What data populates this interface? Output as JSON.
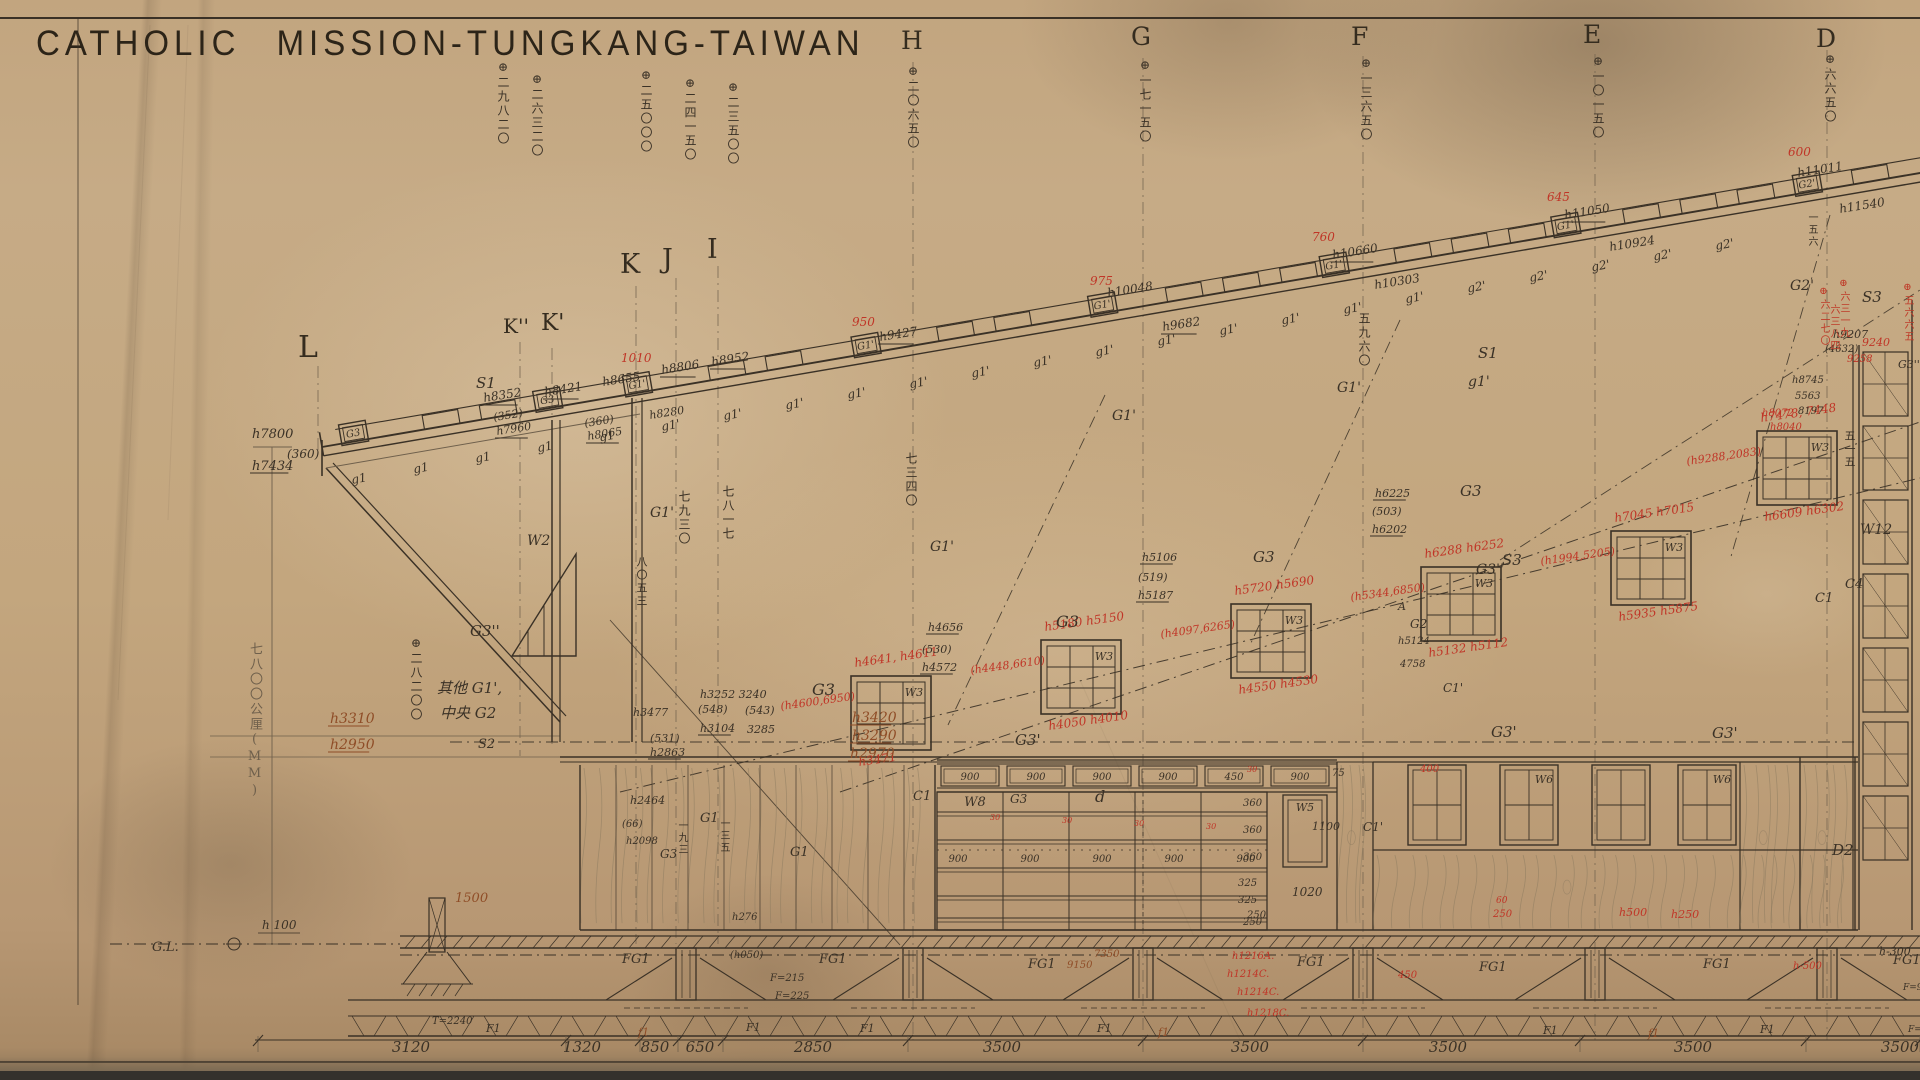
{
  "title": "CATHOLIC MISSION-TUNGKANG-TAIWAN",
  "colors": {
    "paper": "#c3a67e",
    "ink": "#3a3126",
    "pencil": "#77685280",
    "red": "#c03527",
    "brown": "#8f4d27"
  },
  "letters": [
    {
      "t": "L",
      "x": 298,
      "y": 330,
      "s": 30
    },
    {
      "t": "K''",
      "x": 503,
      "y": 314,
      "s": 20
    },
    {
      "t": "K'",
      "x": 541,
      "y": 310,
      "s": 23
    },
    {
      "t": "K",
      "x": 620,
      "y": 249,
      "s": 27
    },
    {
      "t": "J",
      "x": 662,
      "y": 244,
      "s": 27
    },
    {
      "t": "I",
      "x": 707,
      "y": 234,
      "s": 27
    },
    {
      "t": "H",
      "x": 901,
      "y": 26,
      "s": 25
    },
    {
      "t": "G",
      "x": 1131,
      "y": 22,
      "s": 25
    },
    {
      "t": "F",
      "x": 1351,
      "y": 22,
      "s": 25
    },
    {
      "t": "E",
      "x": 1583,
      "y": 20,
      "s": 25
    },
    {
      "t": "D",
      "x": 1816,
      "y": 24,
      "s": 25
    }
  ],
  "grid_lines": [
    {
      "x": 318,
      "y1": 366,
      "y2": 452
    },
    {
      "x": 520,
      "y1": 342,
      "y2": 756
    },
    {
      "x": 552,
      "y1": 348,
      "y2": 745
    },
    {
      "x": 636,
      "y1": 286,
      "y2": 944
    },
    {
      "x": 676,
      "y1": 278,
      "y2": 944
    },
    {
      "x": 718,
      "y1": 266,
      "y2": 944
    },
    {
      "x": 913,
      "y1": 62,
      "y2": 1040
    },
    {
      "x": 1143,
      "y1": 58,
      "y2": 1040
    },
    {
      "x": 1363,
      "y1": 56,
      "y2": 1040
    },
    {
      "x": 1595,
      "y1": 54,
      "y2": 1040
    },
    {
      "x": 1827,
      "y1": 50,
      "y2": 1040
    }
  ],
  "top_columns": [
    {
      "x": 497,
      "y": 60,
      "t": "⊕二九八二〇"
    },
    {
      "x": 531,
      "y": 72,
      "t": "⊕二六三二〇"
    },
    {
      "x": 640,
      "y": 68,
      "t": "⊕二五〇〇〇"
    },
    {
      "x": 684,
      "y": 76,
      "t": "⊕二四一五〇"
    },
    {
      "x": 727,
      "y": 80,
      "t": "⊕二三五〇〇"
    },
    {
      "x": 907,
      "y": 64,
      "t": "⊕二〇六五〇"
    },
    {
      "x": 1139,
      "y": 58,
      "t": "⊕一七一五〇"
    },
    {
      "x": 1360,
      "y": 56,
      "t": "⊕一三六五〇"
    },
    {
      "x": 1592,
      "y": 54,
      "t": "⊕一〇一五〇"
    },
    {
      "x": 1824,
      "y": 52,
      "t": "⊕六六五〇"
    }
  ],
  "vertical_texts": [
    {
      "x": 678,
      "y": 490,
      "t": "七九三〇",
      "c": "vk",
      "s": 12
    },
    {
      "x": 722,
      "y": 485,
      "t": "七八一七",
      "c": "vk",
      "s": 12
    },
    {
      "x": 905,
      "y": 452,
      "t": "七三四〇",
      "c": "vk",
      "s": 12
    },
    {
      "x": 1358,
      "y": 312,
      "t": "五九六〇",
      "c": "vk",
      "s": 12
    },
    {
      "x": 1844,
      "y": 430,
      "t": "五一五",
      "c": "vk",
      "s": 11
    },
    {
      "x": 1806,
      "y": 212,
      "t": "一五六",
      "c": "vk",
      "s": 10
    },
    {
      "x": 636,
      "y": 556,
      "t": "八〇五三",
      "c": "vk",
      "s": 11
    },
    {
      "x": 410,
      "y": 636,
      "t": "⊕二八二〇〇",
      "c": "vk",
      "s": 12
    },
    {
      "x": 248,
      "y": 642,
      "t": "七八〇〇公厘(MM)",
      "c": "vp",
      "s": 13
    },
    {
      "x": 676,
      "y": 820,
      "t": "一九三",
      "c": "vk",
      "s": 10
    },
    {
      "x": 718,
      "y": 818,
      "t": "一三五",
      "c": "vk",
      "s": 10
    },
    {
      "x": 1818,
      "y": 286,
      "t": "⊕六二七〇",
      "c": "vr",
      "s": 10
    },
    {
      "x": 1838,
      "y": 278,
      "t": "⊕六三一九",
      "c": "vr",
      "s": 10
    },
    {
      "x": 1828,
      "y": 304,
      "t": "六三八四",
      "c": "vr",
      "s": 10
    },
    {
      "x": 1902,
      "y": 282,
      "t": "⊕五六六五",
      "c": "vr",
      "s": 10
    }
  ],
  "roof": {
    "x1": 322,
    "y1": 447,
    "x2": 1920,
    "y2": 173,
    "boxes": [
      {
        "lx": 20,
        "t": "G3"
      },
      {
        "lx": 217,
        "t": "G3"
      },
      {
        "lx": 308,
        "t": "G1'"
      },
      {
        "lx": 540,
        "t": "G1'"
      },
      {
        "lx": 780,
        "t": "G1'"
      },
      {
        "lx": 1015,
        "t": "G1'"
      },
      {
        "lx": 1250,
        "t": "G1'"
      },
      {
        "lx": 1495,
        "t": "G2'"
      }
    ]
  },
  "windows_w3": [
    {
      "x": 851,
      "y": 676,
      "label": "W3",
      "top": "h4641, h4611",
      "left": "(h4600,6950)",
      "bottom": "h3471"
    },
    {
      "x": 1041,
      "y": 640,
      "label": "W3",
      "top": "h5180 h5150",
      "left": "(h4448,6610)",
      "bottom": "h4050  h4010"
    },
    {
      "x": 1231,
      "y": 604,
      "label": "W3",
      "top": "h5720 h5690",
      "left": "(h4097,6265)",
      "bottom": "h4550  h4530"
    },
    {
      "x": 1421,
      "y": 567,
      "label": "W3",
      "top": "h6288 h6252",
      "left": "(h5344,6850)",
      "bottom": "h5132  h5112"
    },
    {
      "x": 1611,
      "y": 531,
      "label": "W3",
      "top": "h7045 h7015",
      "left": "(h1994,5205)",
      "bottom": "h5935  h5875"
    },
    {
      "x": 1757,
      "y": 431,
      "label": "W3",
      "top": "h7478, 7448",
      "left": "(h9288,2083)",
      "bottom": "h6609  h6302"
    }
  ],
  "clerestory": {
    "x": 937,
    "x2": 1337,
    "labels": [
      "900",
      "900",
      "900",
      "900",
      "450",
      "900"
    ],
    "w8_label": "W8",
    "end_label": "75"
  },
  "right_windows": [
    {
      "x": 1408,
      "label": ""
    },
    {
      "x": 1500,
      "label": "W6"
    },
    {
      "x": 1592,
      "label": ""
    },
    {
      "x": 1678,
      "label": "W6"
    }
  ],
  "w5": {
    "x": 1283,
    "y": 795,
    "label": "W5",
    "dim_right": "1100",
    "dim_below": "1020"
  },
  "w12": {
    "x": 1859,
    "label": "W12"
  },
  "panel_rows": [
    "360",
    "360",
    "360",
    "325",
    "325",
    "250"
  ],
  "panel_900s": [
    958,
    1030,
    1102,
    1174,
    1246
  ],
  "footings": {
    "centers": [
      686,
      913,
      1143,
      1363,
      1595,
      1827
    ],
    "porch": 437,
    "fg_labels": [
      [
        622,
        963
      ],
      [
        819,
        963
      ],
      [
        1028,
        968
      ],
      [
        1297,
        966
      ],
      [
        1479,
        971
      ],
      [
        1703,
        968
      ],
      [
        1893,
        964
      ]
    ],
    "fg_text": "FG1",
    "f1_labels": [
      [
        486,
        1032
      ],
      [
        746,
        1031
      ],
      [
        860,
        1032
      ],
      [
        1097,
        1032
      ],
      [
        1543,
        1034
      ],
      [
        1760,
        1033
      ]
    ],
    "f1_text": "F1",
    "f1_red": [
      [
        638,
        1036
      ],
      [
        1158,
        1036
      ],
      [
        1648,
        1037
      ]
    ],
    "f1_red_text": "f1"
  },
  "bottom_dims": {
    "y": 1048,
    "ticks": [
      258,
      566,
      640,
      678,
      723,
      908,
      1143,
      1363,
      1580,
      1806,
      1920
    ],
    "labels": [
      {
        "t": "3120",
        "x": 411
      },
      {
        "t": "1320",
        "x": 582
      },
      {
        "t": "850",
        "x": 655
      },
      {
        "t": "650",
        "x": 700
      },
      {
        "t": "2850",
        "x": 813
      },
      {
        "t": "3500",
        "x": 1002
      },
      {
        "t": "3500",
        "x": 1250
      },
      {
        "t": "3500",
        "x": 1448
      },
      {
        "t": "3500",
        "x": 1693
      },
      {
        "t": "3500",
        "x": 1900
      }
    ]
  },
  "gl": {
    "label": "G.L.",
    "h_label": "h 100"
  },
  "annotations": [
    [
      484,
      402,
      "h8352",
      "k",
      12,
      -9,
      1
    ],
    [
      545,
      396,
      "h8421",
      "k",
      12,
      -9,
      1
    ],
    [
      603,
      386,
      "h8655",
      "k",
      12,
      -9,
      0
    ],
    [
      662,
      374,
      "h8806",
      "k",
      12,
      -9,
      1
    ],
    [
      712,
      366,
      "h8952",
      "k",
      12,
      -9,
      1
    ],
    [
      880,
      341,
      "h9427",
      "k",
      12,
      -9,
      1
    ],
    [
      1108,
      297,
      "h10048",
      "k",
      12,
      -9,
      0
    ],
    [
      1163,
      331,
      "h9682",
      "k",
      12,
      -9,
      1
    ],
    [
      1375,
      289,
      "h10303",
      "k",
      12,
      -9,
      0
    ],
    [
      1333,
      259,
      "h10660",
      "k",
      12,
      -9,
      1
    ],
    [
      1565,
      219,
      "h11050",
      "k",
      12,
      -9,
      1
    ],
    [
      1610,
      251,
      "h10924",
      "k",
      12,
      -9,
      0
    ],
    [
      1798,
      177,
      "h11011",
      "k",
      12,
      -9,
      0
    ],
    [
      1840,
      213,
      "h11540",
      "k",
      12,
      -9,
      0
    ],
    [
      852,
      326,
      "950",
      "r",
      12,
      0,
      0
    ],
    [
      1090,
      285,
      "975",
      "r",
      12,
      0,
      0
    ],
    [
      1312,
      241,
      "760",
      "r",
      12,
      0,
      0
    ],
    [
      1547,
      201,
      "645",
      "r",
      12,
      0,
      0
    ],
    [
      1788,
      156,
      "600",
      "r",
      12,
      0,
      0
    ],
    [
      621,
      362,
      "1010",
      "r",
      12,
      0,
      0
    ],
    [
      252,
      438,
      "h7800",
      "k",
      13,
      0,
      0
    ],
    [
      287,
      458,
      "(360)",
      "k",
      12,
      0,
      0
    ],
    [
      252,
      470,
      "h7434",
      "k",
      13,
      0,
      1
    ],
    [
      494,
      421,
      "(352)",
      "k",
      11,
      -9,
      0
    ],
    [
      497,
      435,
      "h7960",
      "k",
      11,
      -9,
      1
    ],
    [
      585,
      427,
      "(360)",
      "k",
      11,
      -9,
      0
    ],
    [
      588,
      440,
      "h8065",
      "k",
      11,
      -9,
      1
    ],
    [
      650,
      419,
      "h8280",
      "k",
      11,
      -9,
      0
    ],
    [
      476,
      388,
      "S1",
      "k",
      15,
      0,
      0
    ],
    [
      1478,
      358,
      "S1",
      "k",
      15,
      0,
      0
    ],
    [
      1468,
      386,
      "g1'",
      "k",
      14,
      0,
      0
    ],
    [
      1502,
      565,
      "S3",
      "k",
      15,
      0,
      0
    ],
    [
      1862,
      302,
      "S3",
      "k",
      15,
      0,
      0
    ],
    [
      470,
      636,
      "G3''",
      "k",
      15,
      0,
      0
    ],
    [
      1476,
      574,
      "G3''",
      "k",
      14,
      0,
      0
    ],
    [
      812,
      695,
      "G3",
      "k",
      16,
      0,
      0
    ],
    [
      1056,
      627,
      "G3",
      "k",
      16,
      0,
      0
    ],
    [
      1253,
      562,
      "G3",
      "k",
      15,
      0,
      0
    ],
    [
      1460,
      496,
      "G3",
      "k",
      15,
      0,
      0
    ],
    [
      1015,
      745,
      "G3'",
      "k",
      15,
      0,
      0
    ],
    [
      1491,
      737,
      "G3'",
      "k",
      15,
      0,
      0
    ],
    [
      1712,
      738,
      "G3'",
      "k",
      15,
      0,
      0
    ],
    [
      650,
      517,
      "G1'",
      "k",
      14,
      0,
      0
    ],
    [
      930,
      551,
      "G1'",
      "k",
      14,
      0,
      0
    ],
    [
      1112,
      420,
      "G1'",
      "k",
      14,
      0,
      0
    ],
    [
      1337,
      392,
      "G1'",
      "k",
      14,
      0,
      0
    ],
    [
      1790,
      290,
      "G2'",
      "k",
      14,
      0,
      0
    ],
    [
      1410,
      628,
      "G2",
      "k",
      12,
      0,
      0
    ],
    [
      1398,
      610,
      "A",
      "k",
      11,
      0,
      0
    ],
    [
      527,
      545,
      "W2",
      "k",
      14,
      0,
      0
    ],
    [
      437,
      693,
      "其他 G1',",
      "k",
      15,
      0,
      0
    ],
    [
      440,
      718,
      "中央 G2",
      "k",
      15,
      0,
      0
    ],
    [
      478,
      748,
      "S2",
      "k",
      13,
      0,
      0
    ],
    [
      633,
      716,
      "h3477",
      "k",
      11,
      0,
      0
    ],
    [
      700,
      698,
      "h3252 3240",
      "k",
      11,
      0,
      0
    ],
    [
      698,
      713,
      "(548)",
      "k",
      11,
      0,
      0
    ],
    [
      745,
      714,
      "(543)",
      "k",
      11,
      0,
      0
    ],
    [
      700,
      732,
      "h3104",
      "k",
      11,
      0,
      1
    ],
    [
      747,
      733,
      "3285",
      "k",
      11,
      0,
      0
    ],
    [
      650,
      742,
      "(531)",
      "k",
      11,
      0,
      0
    ],
    [
      650,
      756,
      "h2863",
      "k",
      11,
      0,
      1
    ],
    [
      630,
      804,
      "h2464",
      "k",
      11,
      0,
      0
    ],
    [
      622,
      827,
      "(66)",
      "k",
      10,
      0,
      0
    ],
    [
      626,
      844,
      "h2098",
      "k",
      10,
      0,
      0
    ],
    [
      660,
      858,
      "G3",
      "k",
      12,
      0,
      0
    ],
    [
      700,
      822,
      "G1",
      "k",
      13,
      0,
      0
    ],
    [
      790,
      856,
      "G1",
      "k",
      13,
      0,
      0
    ],
    [
      330,
      723,
      "h3310",
      "b",
      14,
      0,
      1
    ],
    [
      330,
      749,
      "h2950",
      "b",
      14,
      0,
      1
    ],
    [
      852,
      722,
      "h3420",
      "b",
      14,
      0,
      1
    ],
    [
      852,
      740,
      "h3290",
      "b",
      14,
      0,
      1
    ],
    [
      850,
      758,
      "h2970",
      "b",
      14,
      0,
      1
    ],
    [
      455,
      902,
      "1500",
      "b",
      13,
      0,
      0
    ],
    [
      732,
      920,
      "h276",
      "k",
      10,
      0,
      0
    ],
    [
      730,
      958,
      "(h050)",
      "k",
      10,
      0,
      0
    ],
    [
      928,
      631,
      "h4656",
      "k",
      11,
      0,
      1
    ],
    [
      922,
      653,
      "(530)",
      "k",
      11,
      0,
      0
    ],
    [
      922,
      671,
      "h4572",
      "k",
      11,
      0,
      1
    ],
    [
      1142,
      561,
      "h5106",
      "k",
      11,
      0,
      1
    ],
    [
      1138,
      581,
      "(519)",
      "k",
      11,
      0,
      0
    ],
    [
      1138,
      599,
      "h5187",
      "k",
      11,
      0,
      1
    ],
    [
      1375,
      497,
      "h6225",
      "k",
      11,
      0,
      1
    ],
    [
      1372,
      515,
      "(503)",
      "k",
      11,
      0,
      0
    ],
    [
      1372,
      533,
      "h6202",
      "k",
      11,
      0,
      1
    ],
    [
      1398,
      644,
      "h5124",
      "k",
      10,
      0,
      0
    ],
    [
      1400,
      667,
      "4758",
      "k",
      10,
      0,
      0
    ],
    [
      1443,
      692,
      "C1'",
      "k",
      12,
      0,
      0
    ],
    [
      913,
      800,
      "C1",
      "k",
      13,
      0,
      0
    ],
    [
      1363,
      831,
      "C1'",
      "k",
      12,
      0,
      0
    ],
    [
      1815,
      602,
      "C1",
      "k",
      13,
      0,
      0
    ],
    [
      1845,
      588,
      "C4",
      "k",
      13,
      0,
      0
    ],
    [
      1898,
      368,
      "G3''",
      "k",
      11,
      0,
      0
    ],
    [
      1832,
      855,
      "D2",
      "k",
      15,
      0,
      0
    ],
    [
      1095,
      802,
      "d",
      "k",
      16,
      0,
      0
    ],
    [
      1010,
      803,
      "G3",
      "k",
      12,
      0,
      0
    ],
    [
      1332,
      776,
      "75",
      "k",
      10,
      0,
      0
    ],
    [
      1243,
      806,
      "360",
      "k",
      10,
      0,
      0
    ],
    [
      1243,
      833,
      "360",
      "k",
      10,
      0,
      0
    ],
    [
      1243,
      860,
      "360",
      "k",
      10,
      0,
      0
    ],
    [
      1238,
      886,
      "325",
      "k",
      10,
      0,
      0
    ],
    [
      1238,
      903,
      "325",
      "k",
      10,
      0,
      0
    ],
    [
      1243,
      925,
      "250",
      "k",
      10,
      0,
      0
    ],
    [
      990,
      820,
      "30",
      "r",
      8,
      0,
      0
    ],
    [
      1062,
      823,
      "30",
      "r",
      8,
      0,
      0
    ],
    [
      1134,
      826,
      "30",
      "r",
      8,
      0,
      0
    ],
    [
      1206,
      829,
      "30",
      "r",
      8,
      0,
      0
    ],
    [
      1247,
      772,
      "30",
      "r",
      8,
      0,
      0
    ],
    [
      1420,
      772,
      "400",
      "r",
      10,
      0,
      0
    ],
    [
      1833,
      338,
      "h9207",
      "k",
      11,
      0,
      0
    ],
    [
      1825,
      352,
      "(4632)",
      "k",
      10,
      0,
      0
    ],
    [
      1862,
      346,
      "9240",
      "r",
      11,
      0,
      0
    ],
    [
      1847,
      362,
      "9258",
      "r",
      10,
      0,
      0
    ],
    [
      1792,
      383,
      "h8745",
      "k",
      10,
      0,
      0
    ],
    [
      1795,
      399,
      "5563",
      "k",
      10,
      0,
      0
    ],
    [
      1798,
      414,
      "8197",
      "k",
      10,
      0,
      0
    ],
    [
      1762,
      416,
      "h8072",
      "r",
      10,
      0,
      0
    ],
    [
      1770,
      430,
      "h8040",
      "r",
      10,
      0,
      0
    ],
    [
      432,
      1024,
      "T=2240",
      "k",
      10,
      0,
      0
    ],
    [
      770,
      981,
      "F=215",
      "k",
      10,
      0,
      0
    ],
    [
      775,
      999,
      "F=225",
      "k",
      10,
      0,
      0
    ],
    [
      1067,
      968,
      "9150",
      "b",
      10,
      0,
      0
    ],
    [
      1094,
      957,
      "7350",
      "b",
      10,
      0,
      0
    ],
    [
      1232,
      959,
      "h1216A.",
      "r",
      10,
      0,
      0
    ],
    [
      1227,
      977,
      "h1214C.",
      "r",
      10,
      0,
      0
    ],
    [
      1237,
      995,
      "h1214C.",
      "r",
      10,
      0,
      0
    ],
    [
      1247,
      1016,
      "h1218C.",
      "r",
      10,
      0,
      0
    ],
    [
      1247,
      918,
      "250",
      "k",
      10,
      0,
      0
    ],
    [
      1493,
      917,
      "250",
      "r",
      10,
      0,
      0
    ],
    [
      1496,
      903,
      "60",
      "r",
      9,
      0,
      0
    ],
    [
      1619,
      916,
      "h500",
      "r",
      11,
      0,
      0
    ],
    [
      1671,
      918,
      "h250",
      "r",
      11,
      0,
      0
    ],
    [
      1398,
      978,
      "450",
      "r",
      10,
      0,
      0
    ],
    [
      1879,
      955,
      "h-300",
      "k",
      11,
      0,
      0
    ],
    [
      1793,
      969,
      "h-500",
      "r",
      10,
      0,
      0
    ],
    [
      1903,
      990,
      "F=900",
      "k",
      9,
      0,
      0
    ],
    [
      1908,
      1032,
      "F=1000",
      "k",
      9,
      0,
      0
    ]
  ]
}
